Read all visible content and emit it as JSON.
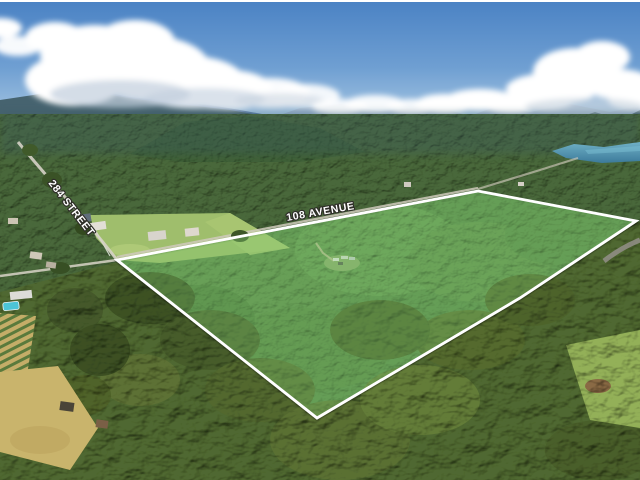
{
  "labels": {
    "avenue": "108 AVENUE",
    "street": "284 STREET"
  },
  "boundary": {
    "color": "#ffffff",
    "fill_tint": "rgba(150,235,130,0.26)"
  },
  "palette": {
    "sky_top": "#4a82c4",
    "sky_horizon": "#d4e4ee",
    "cloud": "#ffffff",
    "far_mountain": "#8fa8c6",
    "mid_mountain": "#5b7da6",
    "near_ridge": "#46636f",
    "lake": "#4f9ab8",
    "forest_mid": "#49683a",
    "forest_foreground": "#4f6830",
    "parcel_interior": "#5a8748",
    "field_green": "#9fbe6c",
    "field_tan": "#c9b46c",
    "pool": "#4cc4d6",
    "road": "#d6d2c6"
  }
}
